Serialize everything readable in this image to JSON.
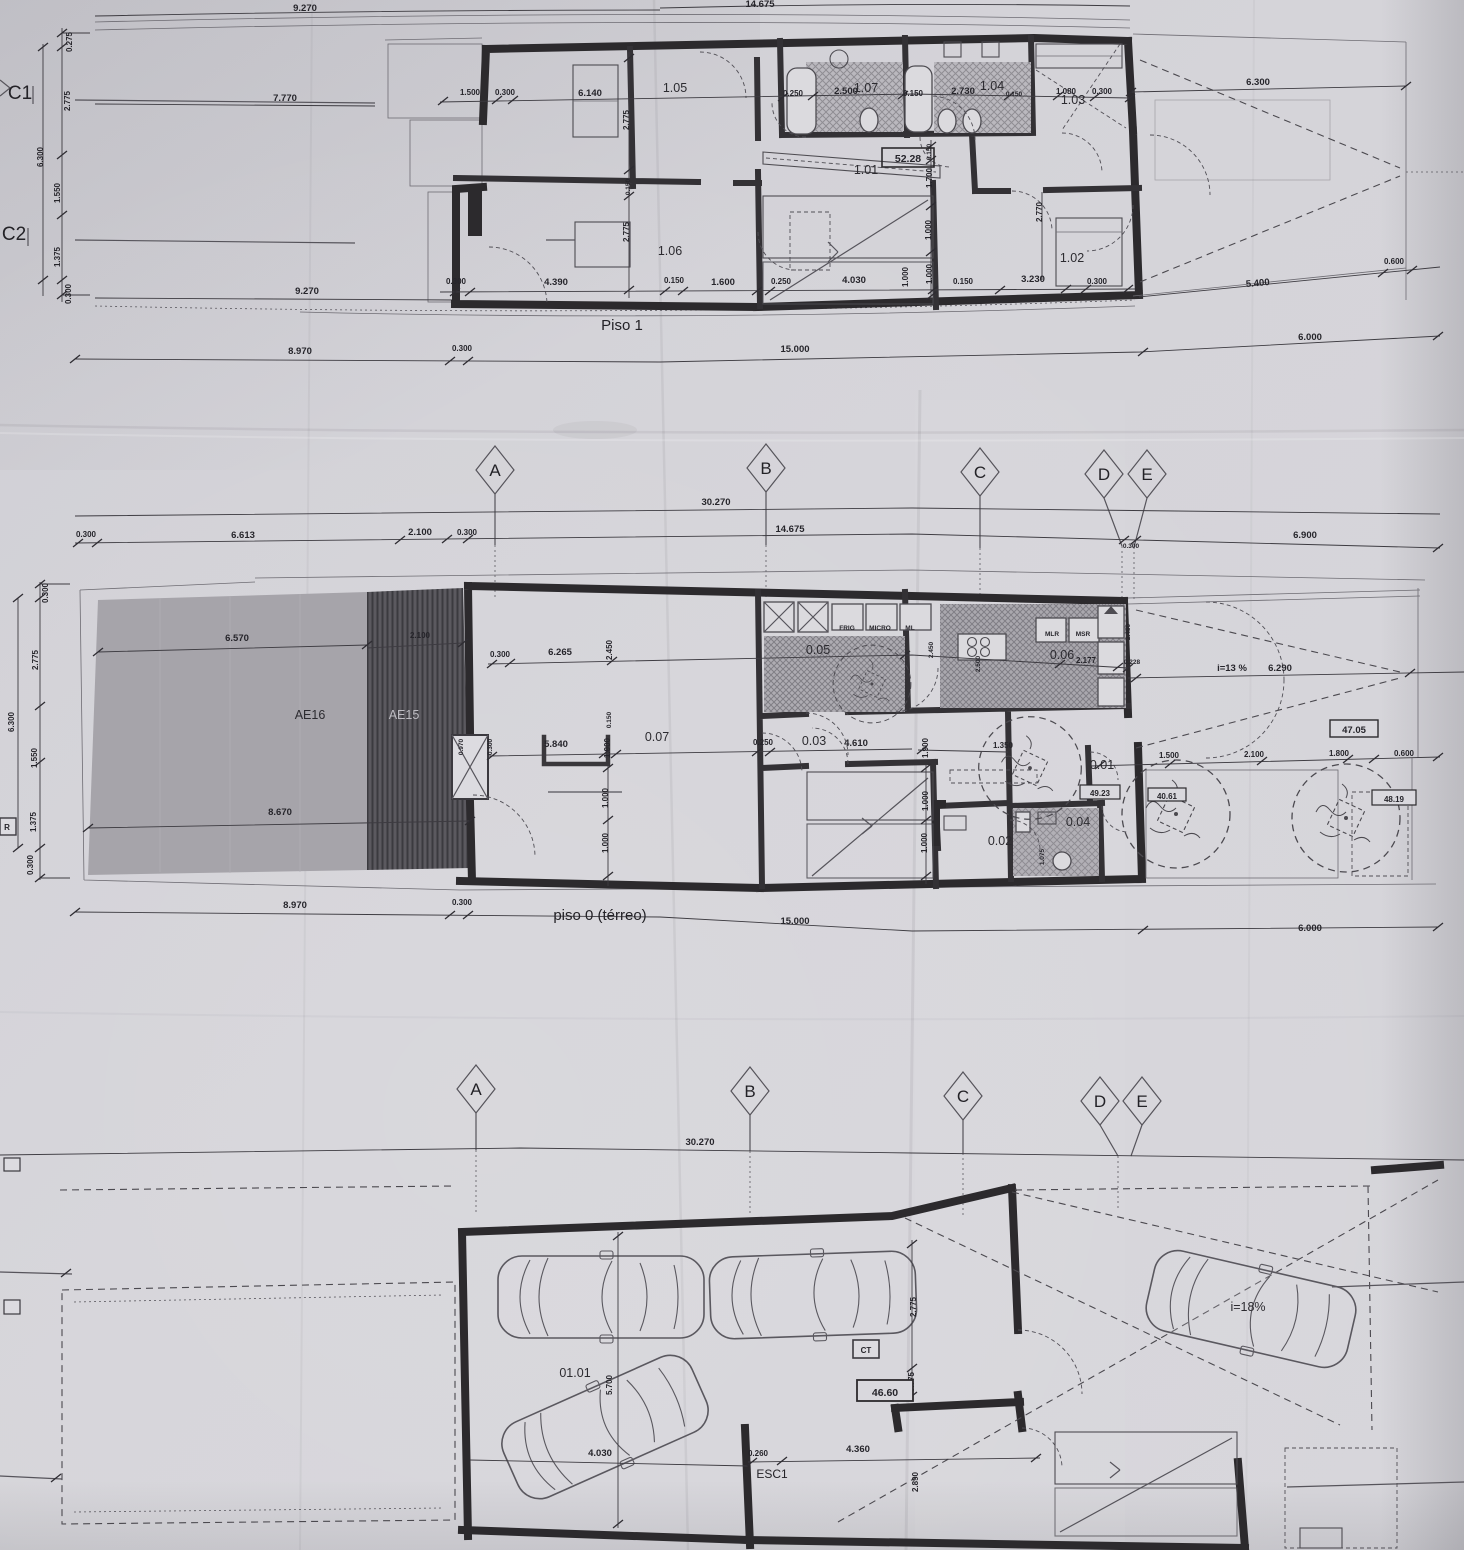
{
  "p1": {
    "title": "Piso 1",
    "c1": "C1",
    "c2": "C2",
    "rooms": {
      "r101": "1.01",
      "r102": "1.02",
      "r103": "1.03",
      "r104": "1.04",
      "r105": "1.05",
      "r106": "1.06",
      "r107": "1.07"
    },
    "area": "52.28",
    "d_top": "9.270",
    "d_top_cut": "14.675",
    "d_7770": "7.770",
    "d_9270b": "9.270",
    "chain": [
      "0.275",
      "2.775",
      "6.300",
      "1.550",
      "1.375",
      "0.300"
    ],
    "upper": [
      "1.500",
      "0.300",
      "6.140",
      "0.250",
      "2.500",
      "0.150",
      "2.730",
      "0.150",
      "1.080",
      "0.300",
      "6.300"
    ],
    "inner": [
      "2.775",
      "0.150",
      "2.775",
      "0.150",
      "1.700",
      "1.000",
      "1.000",
      "2.770"
    ],
    "lower": [
      "0.300",
      "4.390",
      "0.150",
      "1.600",
      "0.250",
      "4.030",
      "1.000",
      "0.150",
      "3.230",
      "0.300",
      "5.400",
      "0.600"
    ],
    "total": [
      "8.970",
      "0.300",
      "15.000",
      "6.000"
    ]
  },
  "g1": {
    "a": "A",
    "b": "B",
    "c": "C",
    "d": "D",
    "e": "E",
    "d1": "30.270",
    "row": [
      "0.300",
      "6.613",
      "2.100",
      "0.300",
      "14.675",
      "0.300",
      "6.900"
    ]
  },
  "p0": {
    "title": "piso 0 (térreo)",
    "r": "R",
    "ae16": "AE16",
    "ae15": "AE15",
    "rooms": {
      "r001": "0.01",
      "r002": "0.02",
      "r003": "0.03",
      "r004": "0.04",
      "r005": "0.05",
      "r006": "0.06",
      "r007": "0.07"
    },
    "boxes": {
      "b1": "47.05",
      "b2": "49.23",
      "b3": "40.61",
      "b4": "48.19"
    },
    "slope": "i=13 %",
    "slope_len": "6.290",
    "appl": {
      "frig": "FRIG",
      "micro": "MICRO",
      "ml": "ML",
      "mlr": "MLR",
      "msr": "MSR"
    },
    "chain": [
      "0.300",
      "2.775",
      "6.300",
      "1.550",
      "1.375",
      "0.300"
    ],
    "patio": [
      "6.570",
      "2.100",
      "8.670",
      "0.970",
      "0.300"
    ],
    "upper": [
      "0.300",
      "6.265",
      "2.450",
      "2.500",
      "2.177",
      "0.228",
      "2.450",
      "2.450"
    ],
    "mid": [
      "5.840",
      "0.150",
      "1.900",
      "0.250",
      "4.610",
      "1.900",
      "1.350",
      "1.500",
      "2.100",
      "1.800",
      "0.600"
    ],
    "low": [
      "1.000",
      "1.000",
      "1.000",
      "1.000",
      "1.075"
    ],
    "total": [
      "8.970",
      "0.300",
      "15.000",
      "6.000"
    ]
  },
  "g2": {
    "a": "A",
    "b": "B",
    "c": "C",
    "d": "D",
    "e": "E",
    "d1": "30.270"
  },
  "pc": {
    "room": "01.01",
    "area": "46.60",
    "ct": "CT",
    "esc": "ESC1",
    "slope": "i=18%",
    "d5700": "5.700",
    "d4030": "4.030",
    "d2775": "2.775",
    "d0775": "0.775",
    "d0260": "0.260",
    "d4360": "4.360",
    "d2890": "2.890"
  }
}
